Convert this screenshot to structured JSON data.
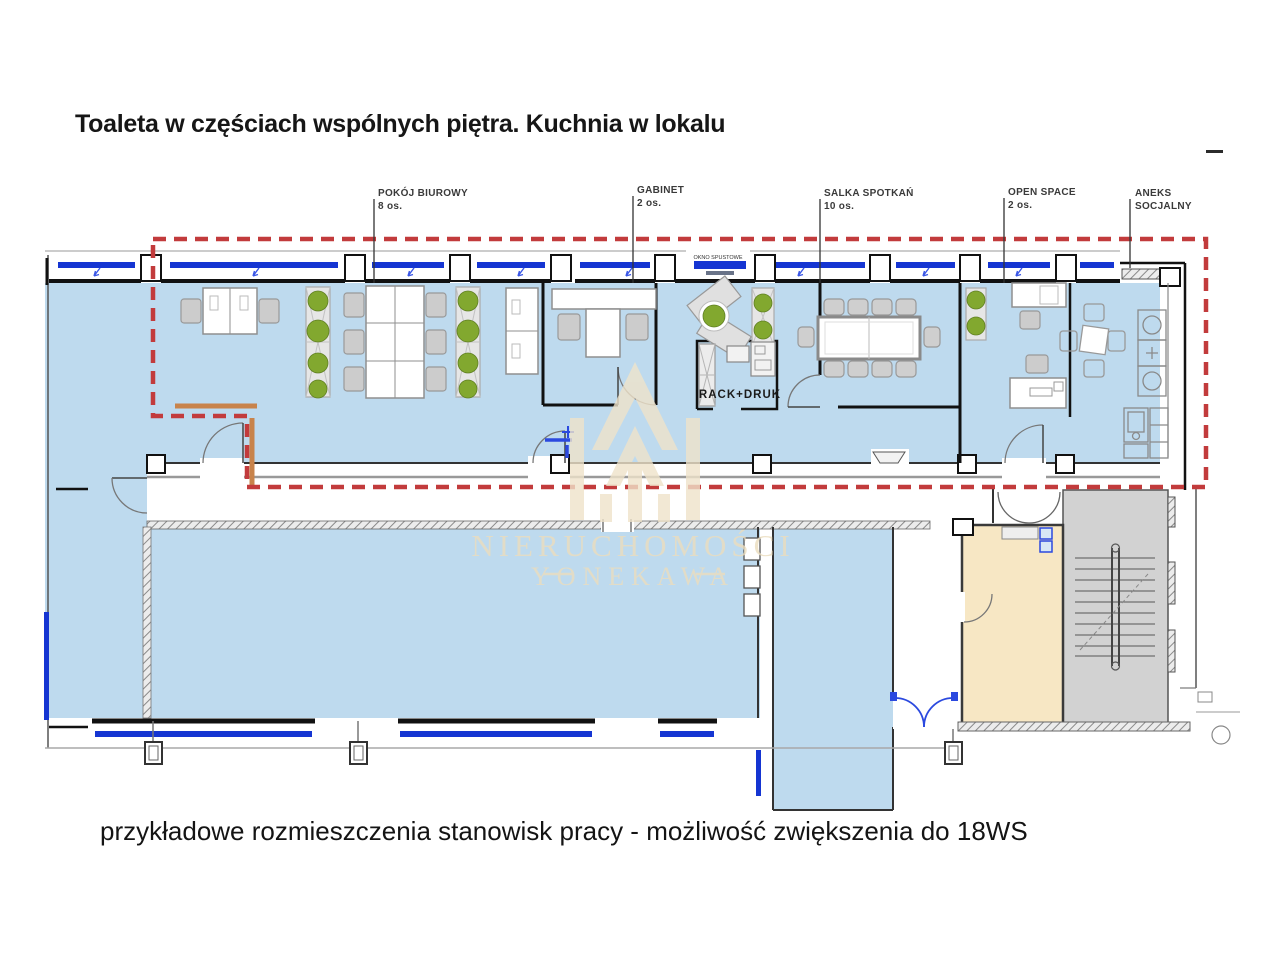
{
  "header": {
    "title": "Toaleta w częściach wspólnych piętra. Kuchnia w lokalu"
  },
  "footer": {
    "caption": "przykładowe rozmieszczenia stanowisk pracy - możliwość zwiększenia do 18WS"
  },
  "plan": {
    "room_labels": [
      {
        "line1": "POKÓJ BIUROWY",
        "line2": "8 os."
      },
      {
        "line1": "GABINET",
        "line2": "2 os."
      },
      {
        "line1": "SALKA SPOTKAŃ",
        "line2": "10 os."
      },
      {
        "line1": "OPEN SPACE",
        "line2": "2 os."
      },
      {
        "line1": "ANEKS",
        "line2": "SOCJALNY"
      }
    ],
    "annotations": {
      "rack_room": "RACK+DRUK",
      "window_note": "OKNO SPUSTOWE"
    }
  },
  "watermark": {
    "line1": "NIERUCHOMOŚCI",
    "line2": "YONEKAWA"
  },
  "colors": {
    "floor_blue": "#BEDAEE",
    "window_blue": "#1535D2",
    "boundary_red": "#C23B3C",
    "beige_room": "#F7E7C4",
    "stair_gray": "#D2D2D2",
    "plant_green": "#82A82F",
    "watermark_beige": "#EBDDBE",
    "orange_wall": "#C8834B"
  }
}
